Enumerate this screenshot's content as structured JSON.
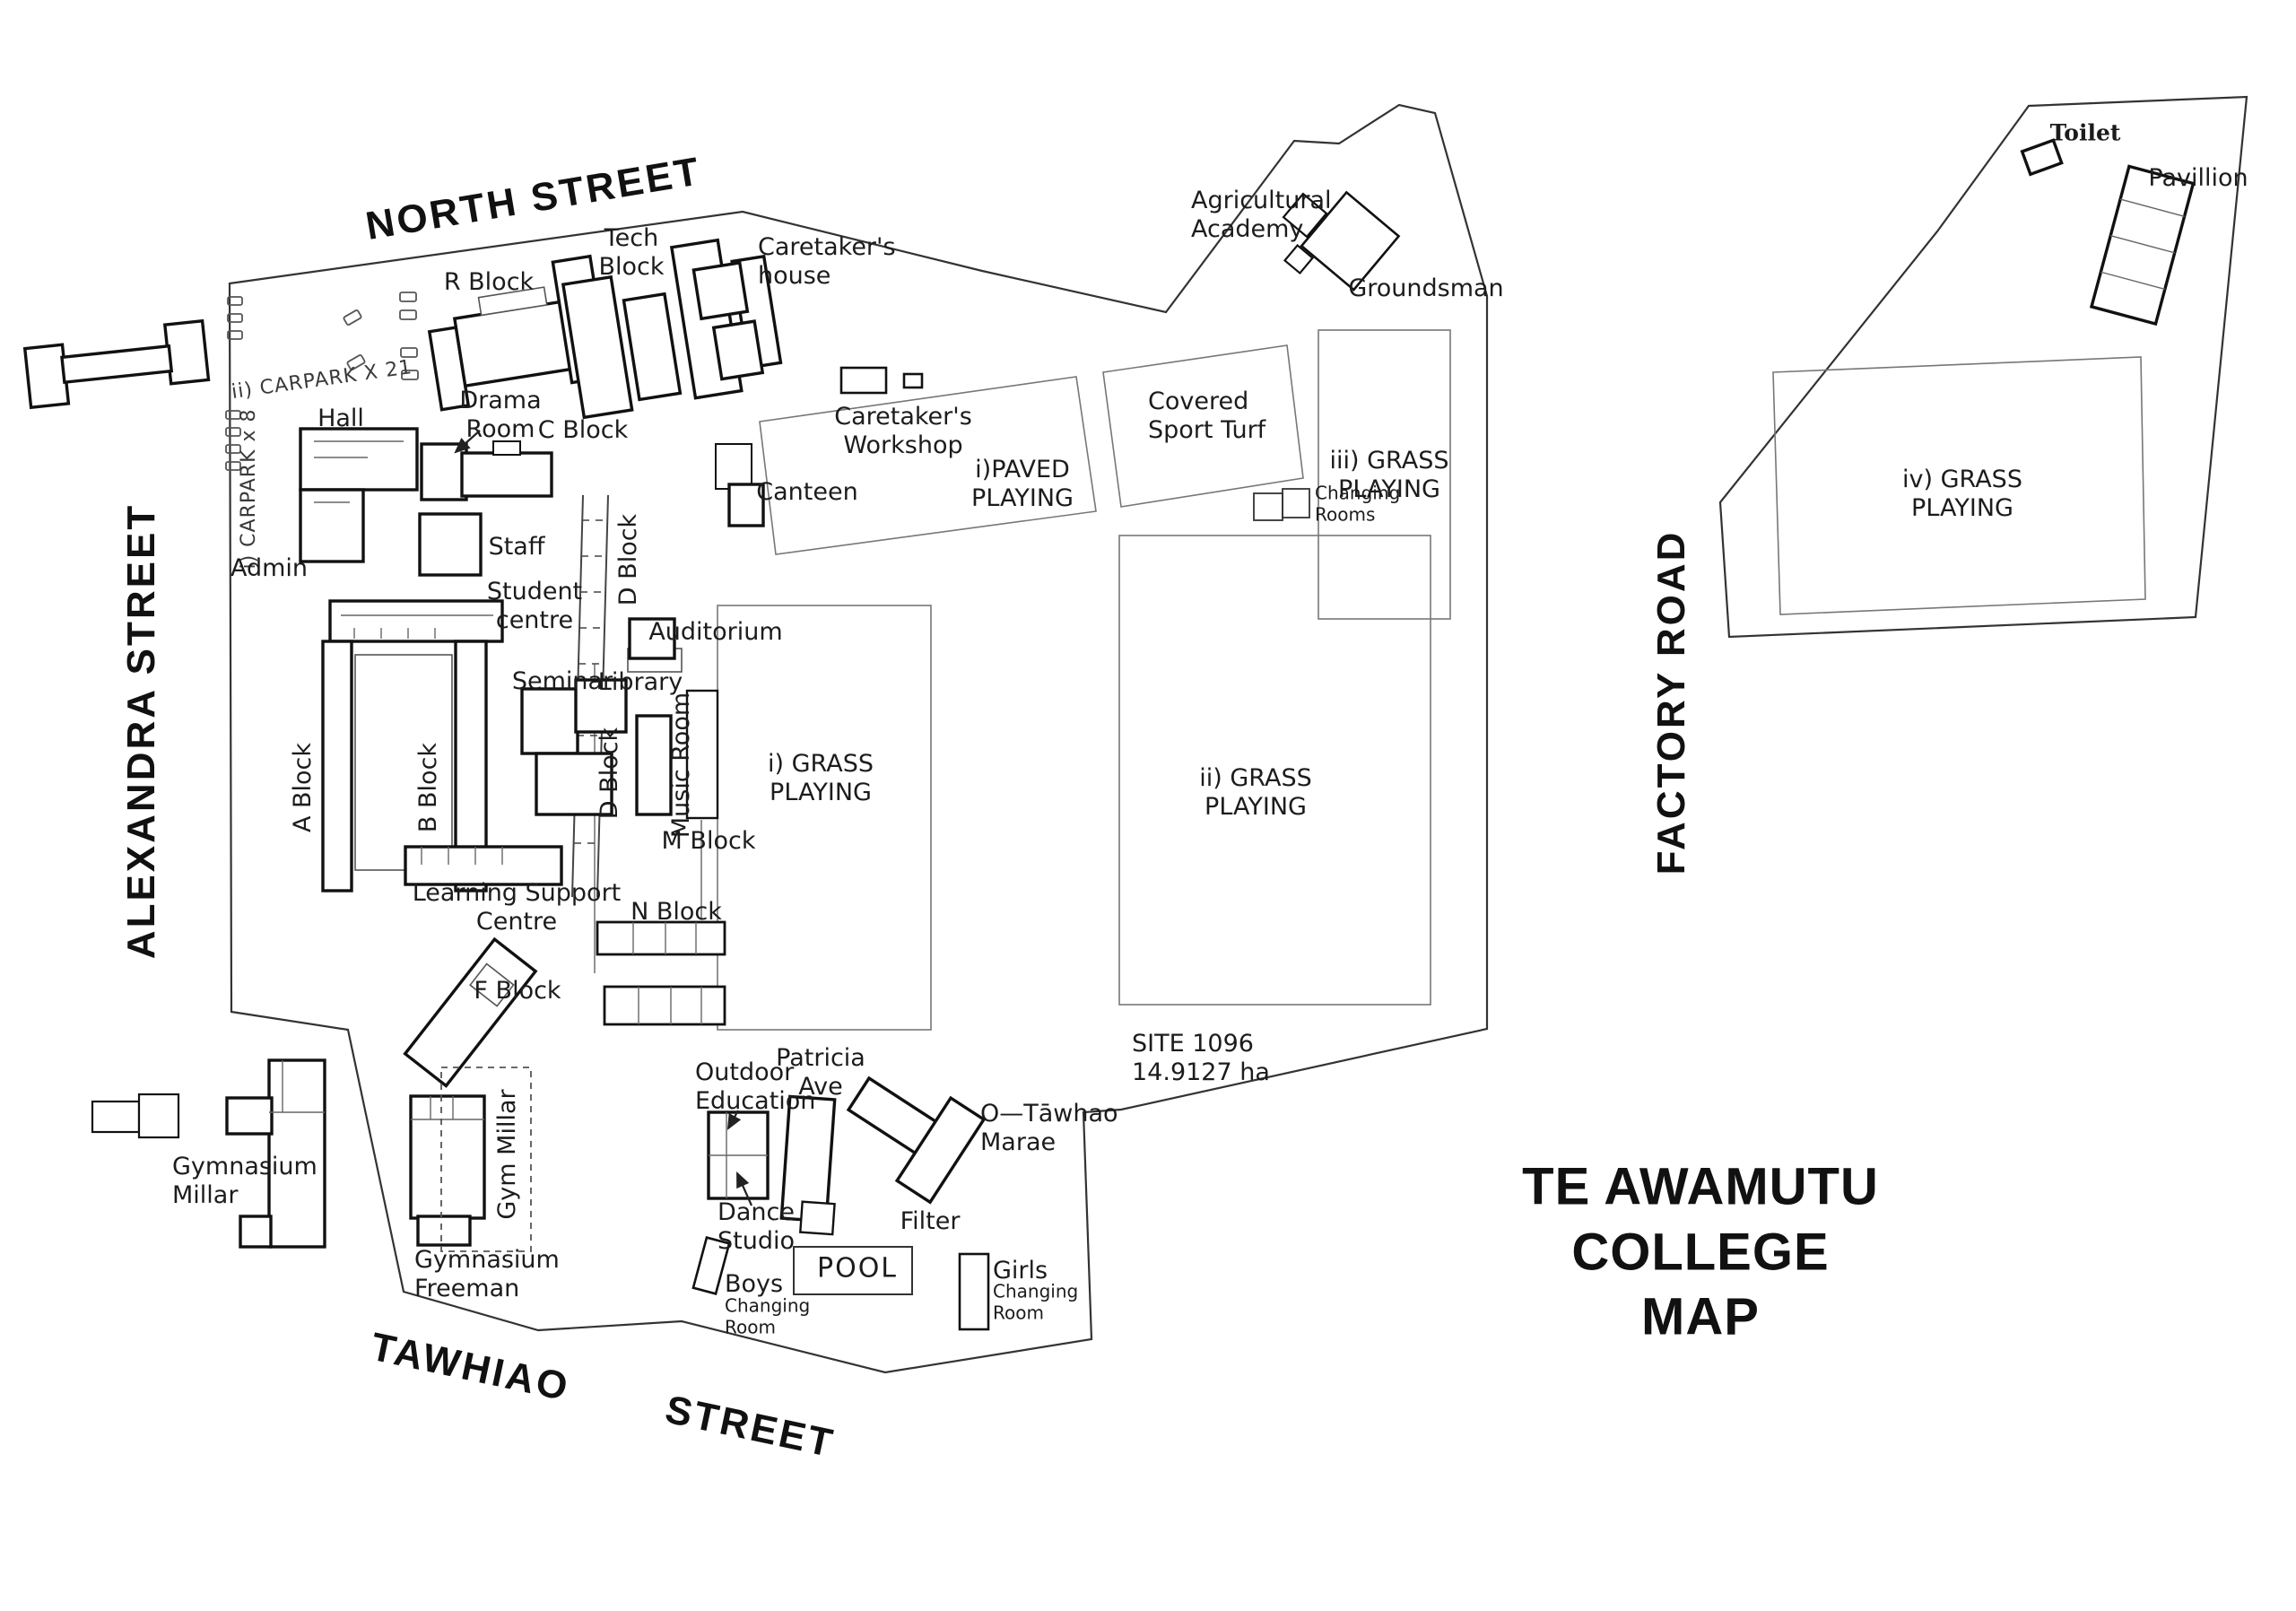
{
  "title": "TE AWAMUTU COLLEGE\nMAP",
  "streets": {
    "north": "NORTH STREET",
    "alexandra": "ALEXANDRA STREET",
    "factory": "FACTORY ROAD",
    "tawhiao": "TAWHIAO STREET"
  },
  "site": {
    "info": "SITE 1096\n14.9127  ha"
  },
  "carparks": {
    "carpark_21": "ii) CARPARK X 21",
    "carpark_8": "i) CARPARK x 8"
  },
  "areas": {
    "paved_playing": "i)PAVED\nPLAYING",
    "grass_i": "i) GRASS\nPLAYING",
    "grass_ii": "ii)  GRASS\nPLAYING",
    "grass_iii": "iii) GRASS\nPLAYING",
    "grass_iv": "iv) GRASS\nPLAYING",
    "covered_sport_turf": "Covered\nSport Turf"
  },
  "buildings": {
    "r_block": "R Block",
    "tech_block": "Tech\nBlock",
    "caretakers_house": "Caretaker's\nhouse",
    "drama_room": "Drama\nRoom",
    "c_block": "C Block",
    "hall": "Hall",
    "admin": "Admin",
    "staff": "Staff",
    "student_centre": "Student\ncentre",
    "seminar": "Seminar",
    "library": "Library",
    "auditorium": "Auditorium",
    "d_block": "D Block",
    "a_block": "A Block",
    "b_block": "B Block",
    "music_room": "Music Room",
    "m_block": "M Block",
    "n_block": "N Block",
    "learning_support": "Learning Support\nCentre",
    "f_block": "F Block",
    "canteen": "Canteen",
    "caretakers_workshop": "Caretaker's\nWorkshop",
    "changing_rooms": "Changing\nRooms",
    "agricultural_academy": "Agricultural\nAcademy",
    "groundsman": "Groundsman",
    "toilet": "Toilet",
    "pavillion": "Pavillion",
    "gymnasium_millar": "Gymnasium\nMillar",
    "gym_millar": "Gym Millar",
    "gymnasium_freeman": "Gymnasium\nFreeman",
    "outdoor_education": "Outdoor\nEducation",
    "patricia_ave": "Patricia\nAve",
    "dance_studio": "Dance\nStudio",
    "o_tawhao_marae": "O—Tāwhao\nMarae",
    "filter": "Filter",
    "pool": "POOL",
    "boys": "Boys",
    "girls": "Girls",
    "changing_room": "Changing\nRoom"
  }
}
